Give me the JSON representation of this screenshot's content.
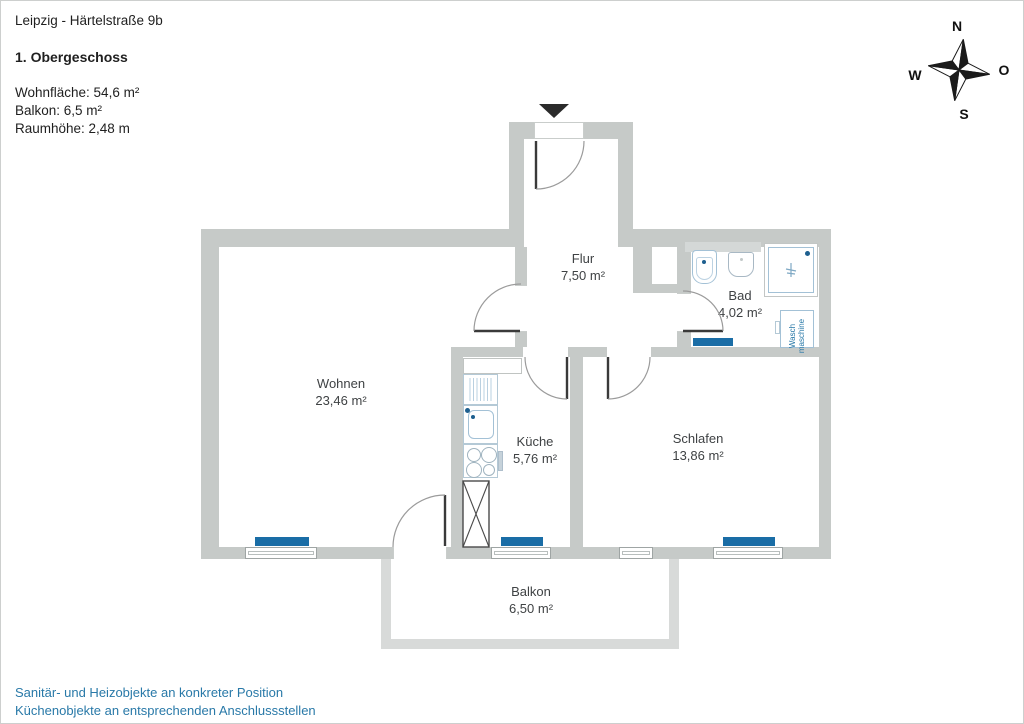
{
  "header": {
    "location": "Leipzig - Härtelstraße 9b",
    "floor": "1. Obergeschoss",
    "stat_area": "Wohnfläche: 54,6 m²",
    "stat_balcony": "Balkon: 6,5 m²",
    "stat_height": "Raumhöhe: 2,48 m"
  },
  "rooms": {
    "flur": {
      "name": "Flur",
      "area": "7,50 m²"
    },
    "bad": {
      "name": "Bad",
      "area": "4,02 m²"
    },
    "wohnen": {
      "name": "Wohnen",
      "area": "23,46 m²"
    },
    "kueche": {
      "name": "Küche",
      "area": "5,76 m²"
    },
    "schlafen": {
      "name": "Schlafen",
      "area": "13,86 m²"
    },
    "balkon": {
      "name": "Balkon",
      "area": "6,50 m²"
    }
  },
  "fixtures": {
    "washing_machine_line1": "Wasch",
    "washing_machine_line2": "maschine"
  },
  "compass": {
    "north": "N",
    "east": "O",
    "south": "S",
    "west": "W"
  },
  "footer": {
    "line1": "Sanitär- und Heizobjekte an konkreter Position",
    "line2": "Küchenobjekte an entsprechenden Anschlussstellen"
  },
  "colors": {
    "wall": "#c6cac8",
    "balcony_wall": "#d8dad9",
    "radiator": "#1a6da6",
    "fixture_outline": "#a3c1d6",
    "accent_text": "#2979a8"
  }
}
